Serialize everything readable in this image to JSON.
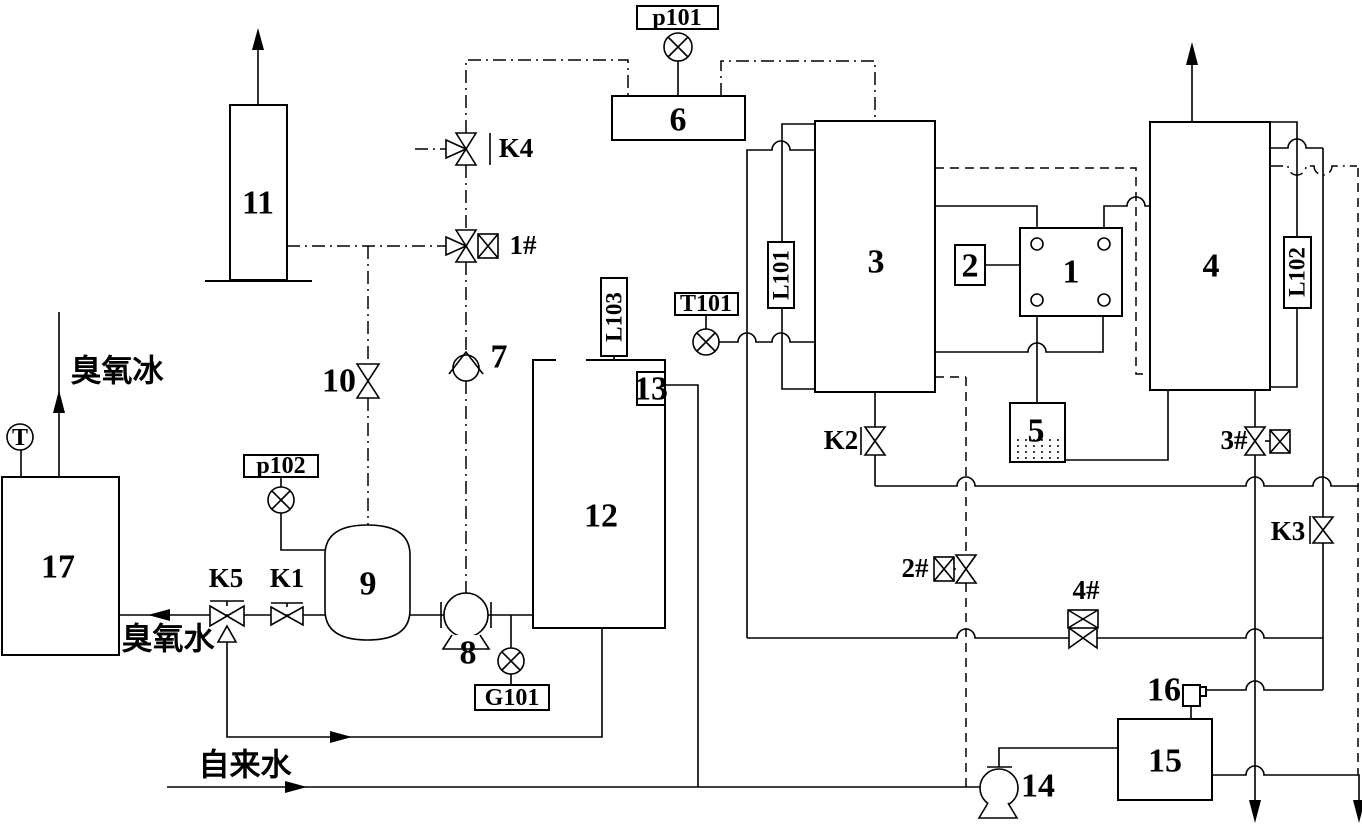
{
  "diagram": {
    "background": "#ffffff",
    "line_color": "#000000",
    "equipment": {
      "e1": "1",
      "e2": "2",
      "e3": "3",
      "e4": "4",
      "e5": "5",
      "e6": "6",
      "e7": "7",
      "e8": "8",
      "e9": "9",
      "e10": "10",
      "e11": "11",
      "e12": "12",
      "e13": "13",
      "e14": "14",
      "e15": "15",
      "e16": "16",
      "e17": "17"
    },
    "instruments": {
      "p101": "p101",
      "p102": "p102",
      "t101": "T101",
      "g101": "G101",
      "l101": "L101",
      "l102": "L102",
      "l103": "L103",
      "t": "T"
    },
    "valves": {
      "k1": "K1",
      "k2": "K2",
      "k3": "K3",
      "k4": "K4",
      "k5": "K5",
      "n1": "1#",
      "n2": "2#",
      "n3": "3#",
      "n4": "4#"
    },
    "streams": {
      "ozone_ice": "臭氧冰",
      "ozone_water": "臭氧水",
      "tap_water": "自来水"
    }
  }
}
